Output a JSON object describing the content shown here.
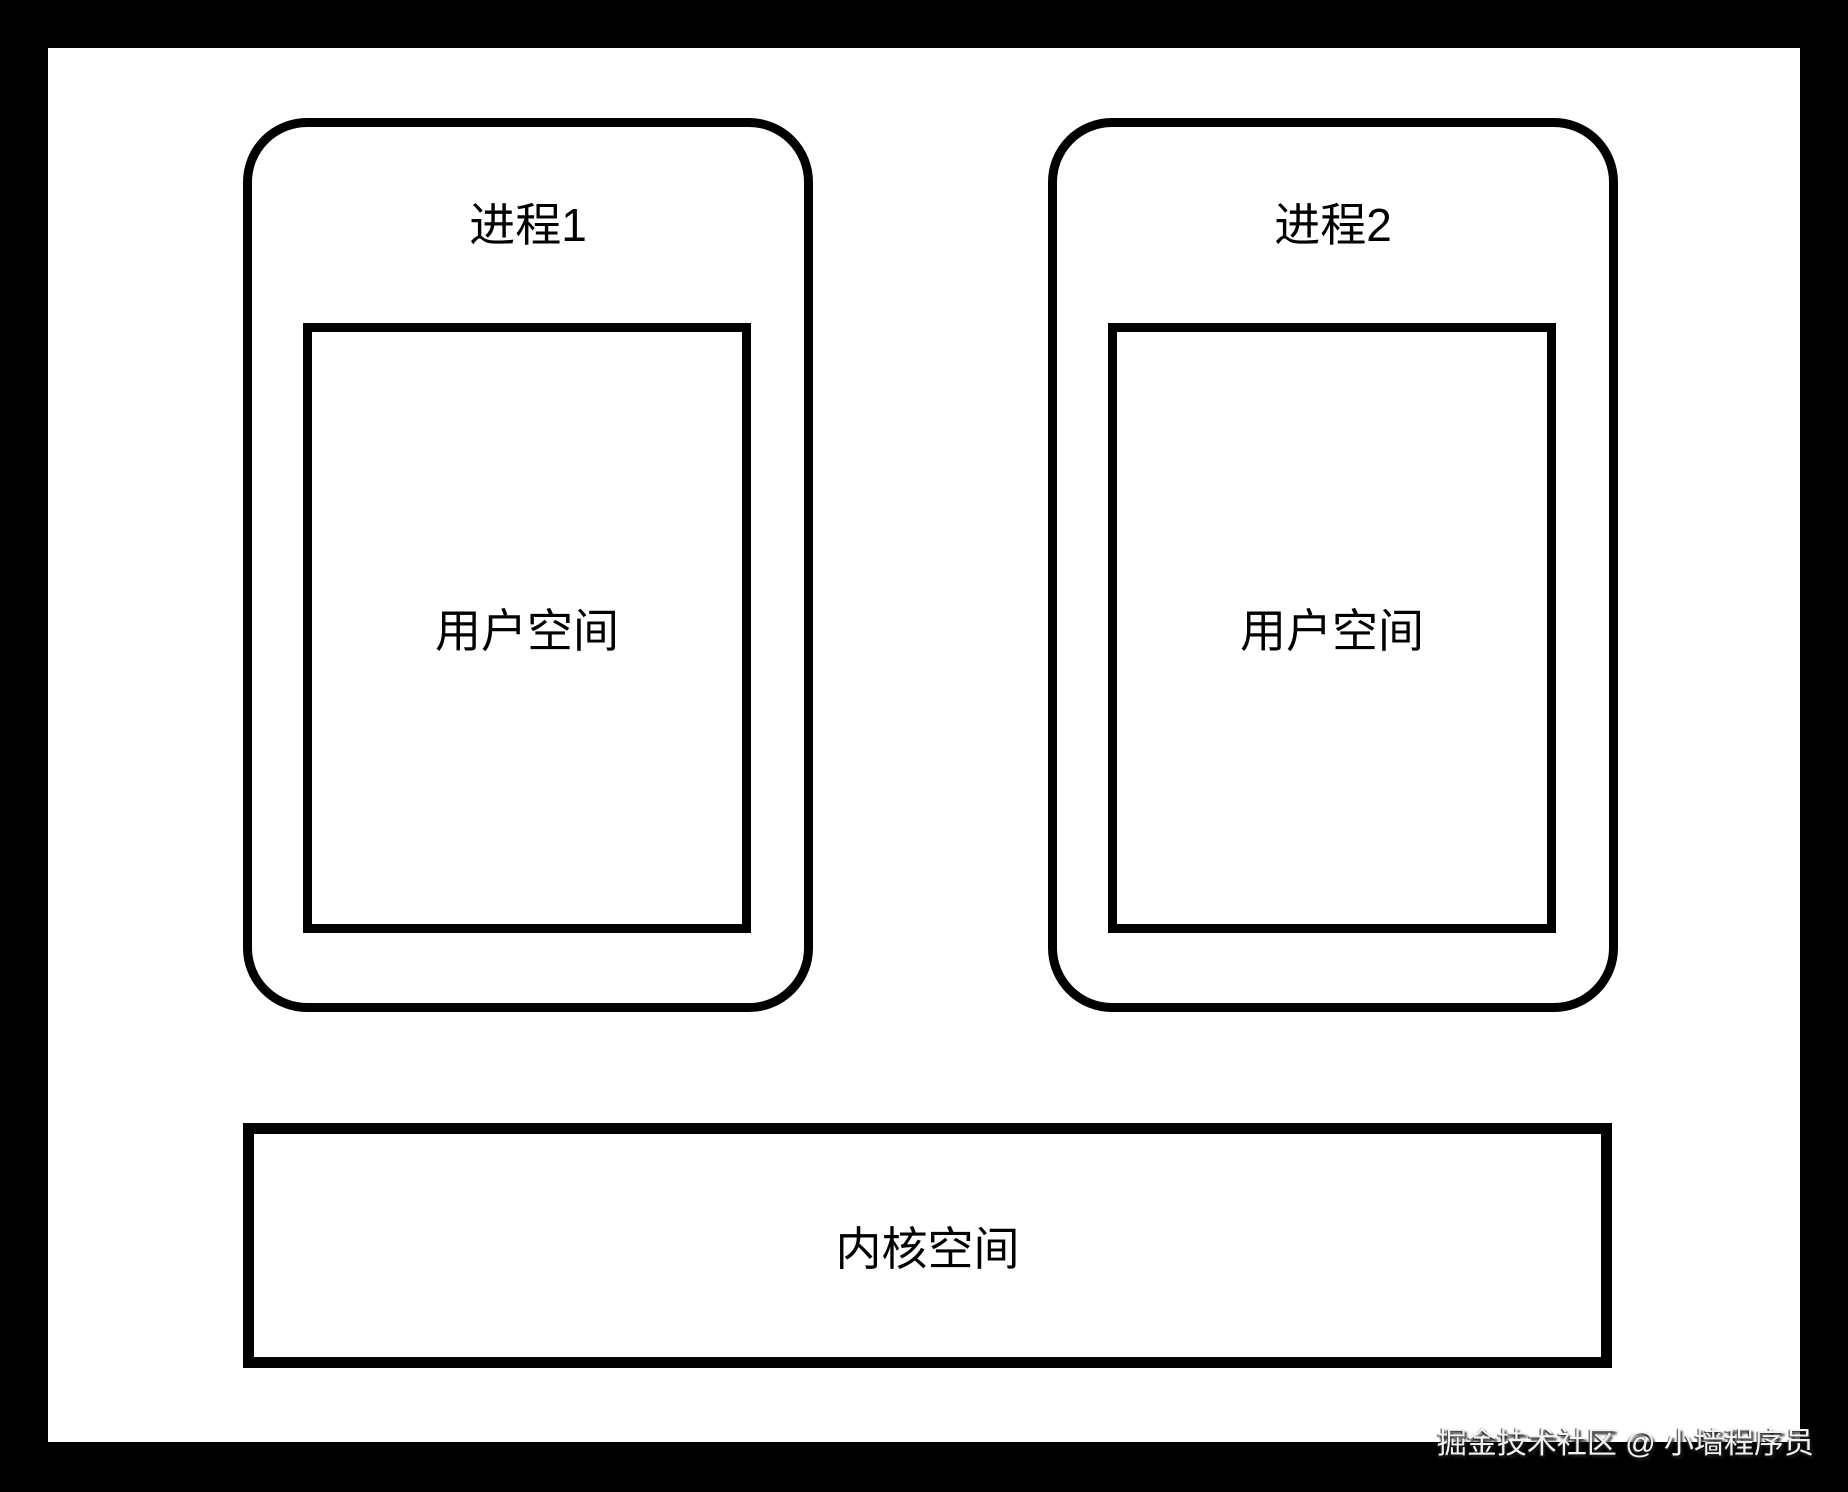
{
  "diagram": {
    "title_context": "process user-space vs kernel-space memory layout",
    "process1": {
      "title": "进程1",
      "user_space_label": "用户空间"
    },
    "process2": {
      "title": "进程2",
      "user_space_label": "用户空间"
    },
    "kernel": {
      "label": "内核空间"
    },
    "watermark": "掘金技术社区 @ 小墙程序员",
    "colors": {
      "line": "#000000",
      "background": "#ffffff",
      "frame": "#000000",
      "watermark_text": "#f2f2f2"
    }
  }
}
